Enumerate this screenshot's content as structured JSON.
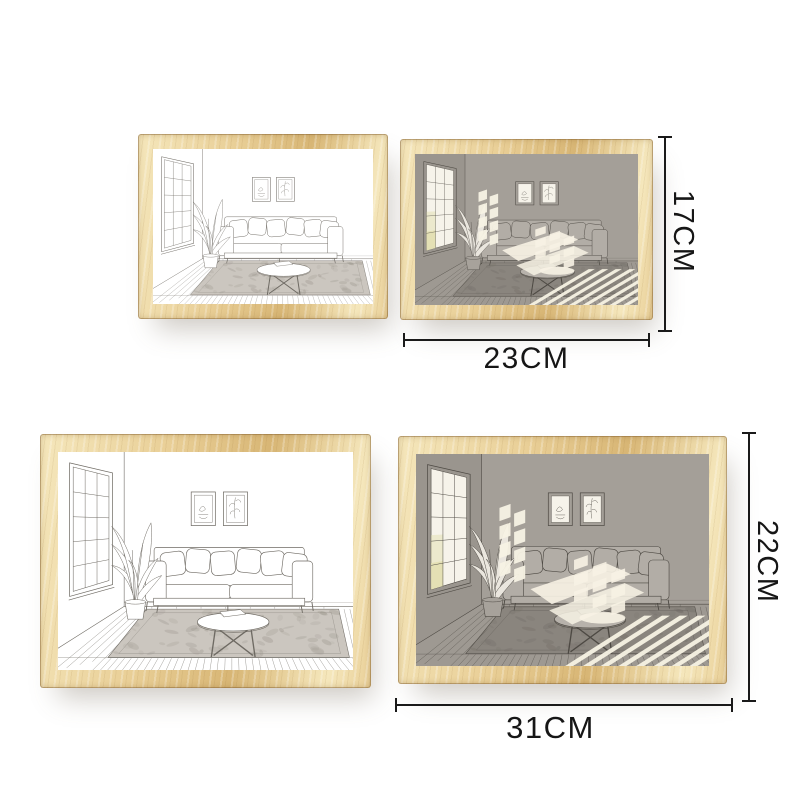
{
  "dimensions": {
    "small": {
      "width_label": "23CM",
      "height_label": "17CM"
    },
    "large": {
      "width_label": "31CM",
      "height_label": "22CM"
    }
  },
  "frames": [
    {
      "id": "small-light",
      "size": "small",
      "variant": "light"
    },
    {
      "id": "small-grey",
      "size": "small",
      "variant": "grey"
    },
    {
      "id": "large-light",
      "size": "large",
      "variant": "light"
    },
    {
      "id": "large-grey",
      "size": "large",
      "variant": "grey"
    }
  ],
  "artwork_subjects": [
    "window-with-panes",
    "potted-plant",
    "sofa-with-pillows",
    "two-wall-pictures",
    "round-coffee-table-with-book",
    "textured-rug",
    "plank-wood-floor",
    "sunlight-beams-grey-variant"
  ],
  "colors": {
    "page_bg": "#ffffff",
    "wood_hi": "#f5e7bc",
    "wood_mid": "#e9cf97",
    "wood_lo": "#d8b675",
    "dim_line": "#1a1a1a",
    "label_text": "#161616",
    "sketch_line": "#6e6a63",
    "sketch_line_dark": "#4d4943",
    "grey_wall": "#a49f98",
    "grey_side": "#9a958e",
    "grey_floor": "#9e9992",
    "grey_rug": "#8a857e",
    "grey_sofa": "#b2ada6",
    "grey_table": "#b7b2ab",
    "grey_leaf": "#eae6de",
    "grey_pot": "#a7a29b",
    "light_rug": "#cbc6bf",
    "sun": "#f7f2e4",
    "pane_glow": "#f6f3ea",
    "pane_yellow": "#e4e0b4"
  }
}
